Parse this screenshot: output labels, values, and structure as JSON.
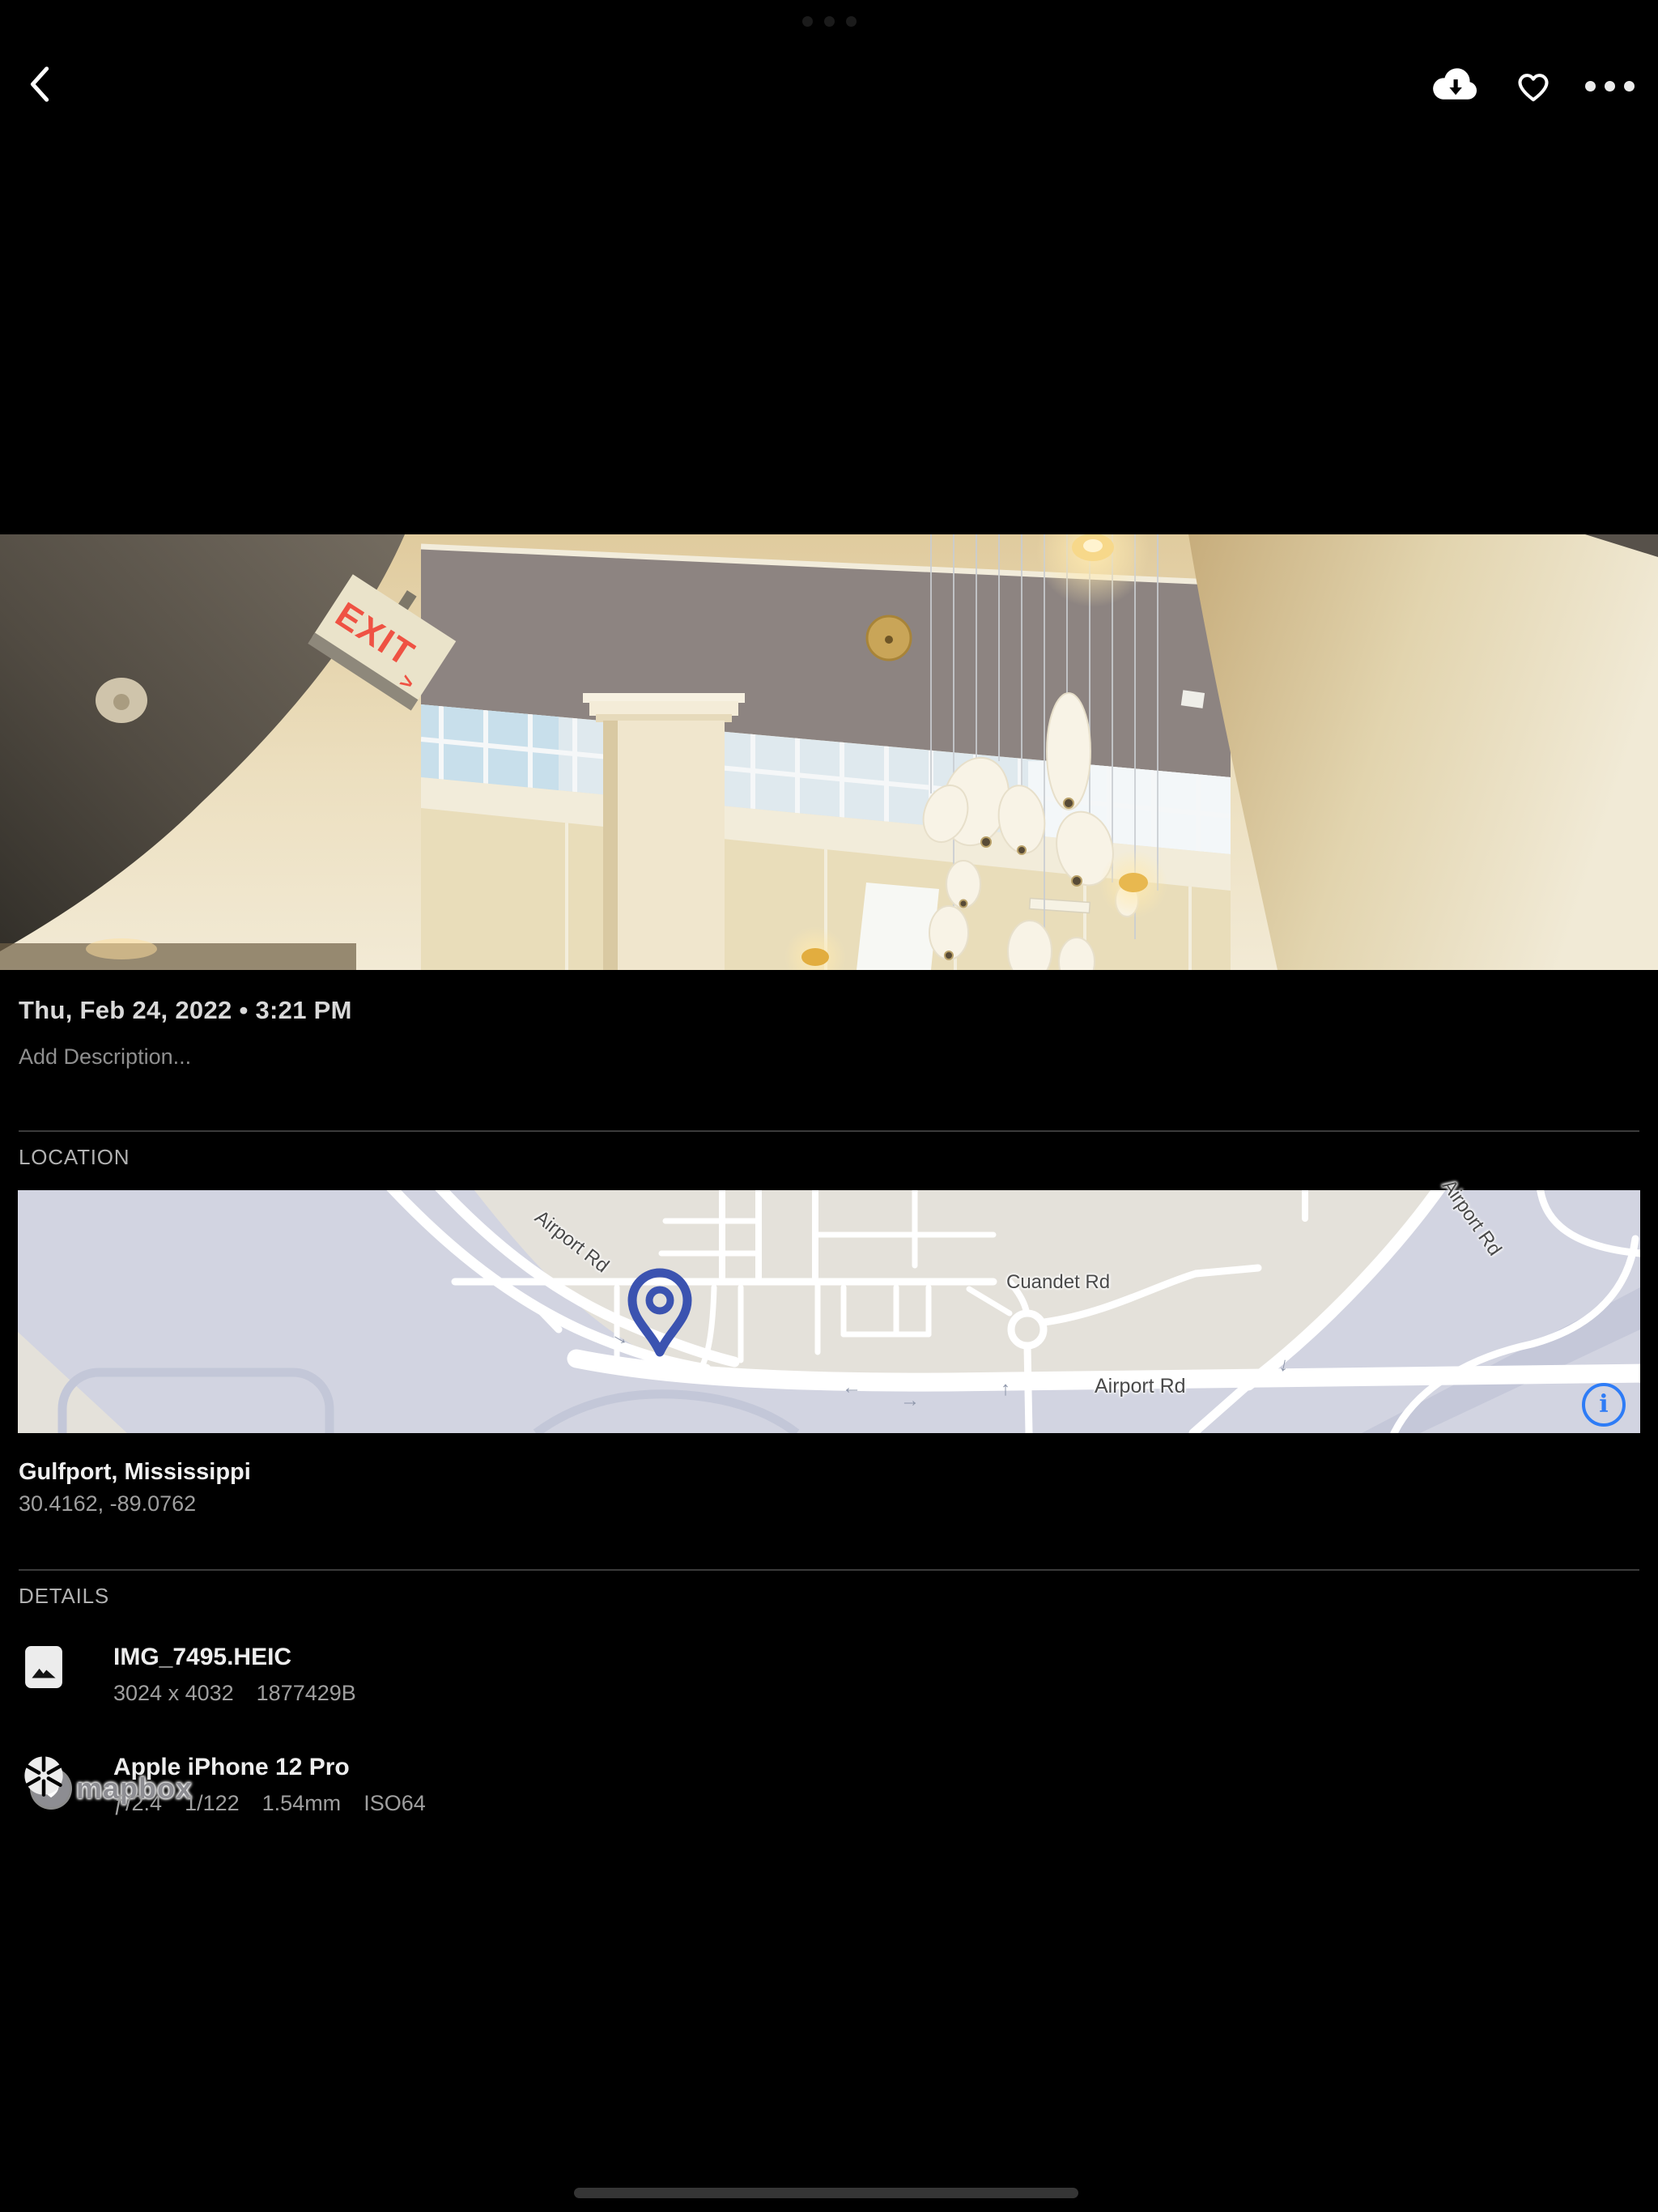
{
  "colors": {
    "background": "#000000",
    "accent_blue": "#2e7cf6",
    "map_pin_blue": "#3b53b0",
    "map_land": "#e4e1da",
    "map_field": "#d2d4e1"
  },
  "top_bar": {
    "icons": [
      "back",
      "download",
      "favorite",
      "more"
    ]
  },
  "photo": {
    "exit_sign_text": "EXIT",
    "exit_sign_arrow": ">"
  },
  "metadata": {
    "datetime": "Thu, Feb 24, 2022 • 3:21 PM",
    "description_placeholder": "Add Description..."
  },
  "location": {
    "section_label": "LOCATION",
    "place": "Gulfport, Mississippi",
    "coordinates": "30.4162, -89.0762",
    "map": {
      "attribution": "mapbox",
      "road_labels": {
        "airport_rd": "Airport Rd",
        "cuandet_rd": "Cuandet Rd"
      },
      "arrows": {
        "left": "←",
        "right": "→",
        "up": "↑",
        "down": "↓",
        "diag": "→"
      },
      "info_glyph": "i"
    }
  },
  "details": {
    "section_label": "DETAILS",
    "file": {
      "name": "IMG_7495.HEIC",
      "dimensions": "3024 x 4032",
      "size": "1877429B"
    },
    "camera": {
      "model": "Apple iPhone 12 Pro",
      "aperture": "ƒ/2.4",
      "shutter": "1/122",
      "focal_length": "1.54mm",
      "iso": "ISO64"
    }
  }
}
